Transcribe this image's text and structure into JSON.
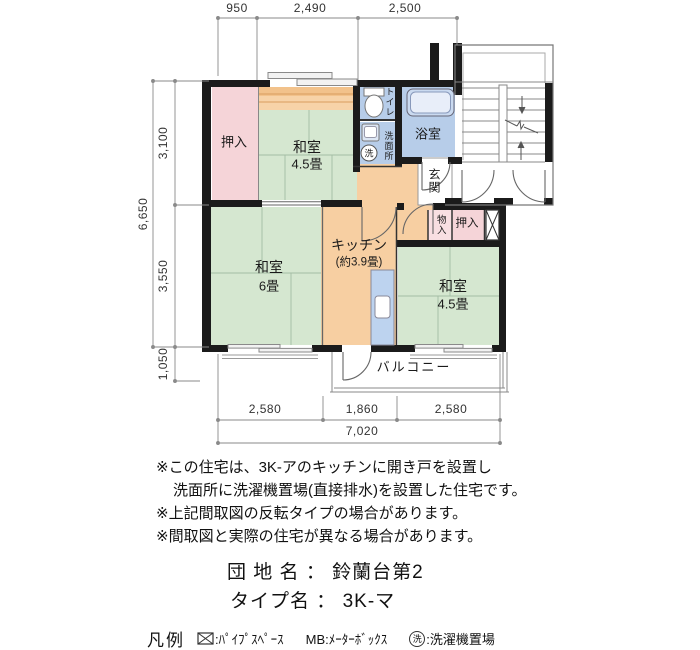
{
  "colors": {
    "tatami_green": "#d5e7d0",
    "closet_pink": "#f5d4d8",
    "kitchen_orange": "#f7cfa2",
    "water_blue": "#b7cde9",
    "wall_black": "#1b1b1b"
  },
  "plan": {
    "dims": {
      "top": [
        "950",
        "2,490",
        "2,500"
      ],
      "left_total": "6,650",
      "left": [
        "3,100",
        "3,550",
        "1,050"
      ],
      "bottom": [
        "2,580",
        "1,860",
        "2,580"
      ],
      "bottom_total": "7,020"
    },
    "rooms": {
      "oshiire_left": "押入",
      "washitsu_top_name": "和室",
      "washitsu_top_size": "4.5畳",
      "toilet": "トイレ",
      "washroom": "洗面所",
      "laundry_symbol": "洗",
      "bath": "浴室",
      "entrance": "玄関",
      "storage": "物入",
      "oshiire_right": "押入",
      "kitchen_name": "キッチン",
      "kitchen_size": "(約3.9畳)",
      "washitsu6_name": "和室",
      "washitsu6_size": "6畳",
      "washitsu_br_name": "和室",
      "washitsu_br_size": "4.5畳",
      "balcony": "バルコニー"
    }
  },
  "notes": {
    "line1": "※この住宅は、3K-アのキッチンに開き戸を設置し",
    "line2": "洗面所に洗濯機置場(直接排水)を設置した住宅です。",
    "line3": "※上記間取図の反転タイプの場合があります。",
    "line4": "※間取図と実際の住宅が異なる場合があります。"
  },
  "title": {
    "estate_label": "団 地 名",
    "estate_sep": "：",
    "estate_value": "鈴蘭台第2",
    "type_label": "タイプ名",
    "type_sep": "：",
    "type_value": "3K-マ"
  },
  "legend": {
    "heading": "凡例",
    "pipe_label": ":ﾊﾟｲﾌﾟｽﾍﾟｰｽ",
    "mb_label": "MB:ﾒｰﾀｰﾎﾞｯｸｽ",
    "laundry_symbol": "洗",
    "laundry_label": ":洗濯機置場"
  }
}
